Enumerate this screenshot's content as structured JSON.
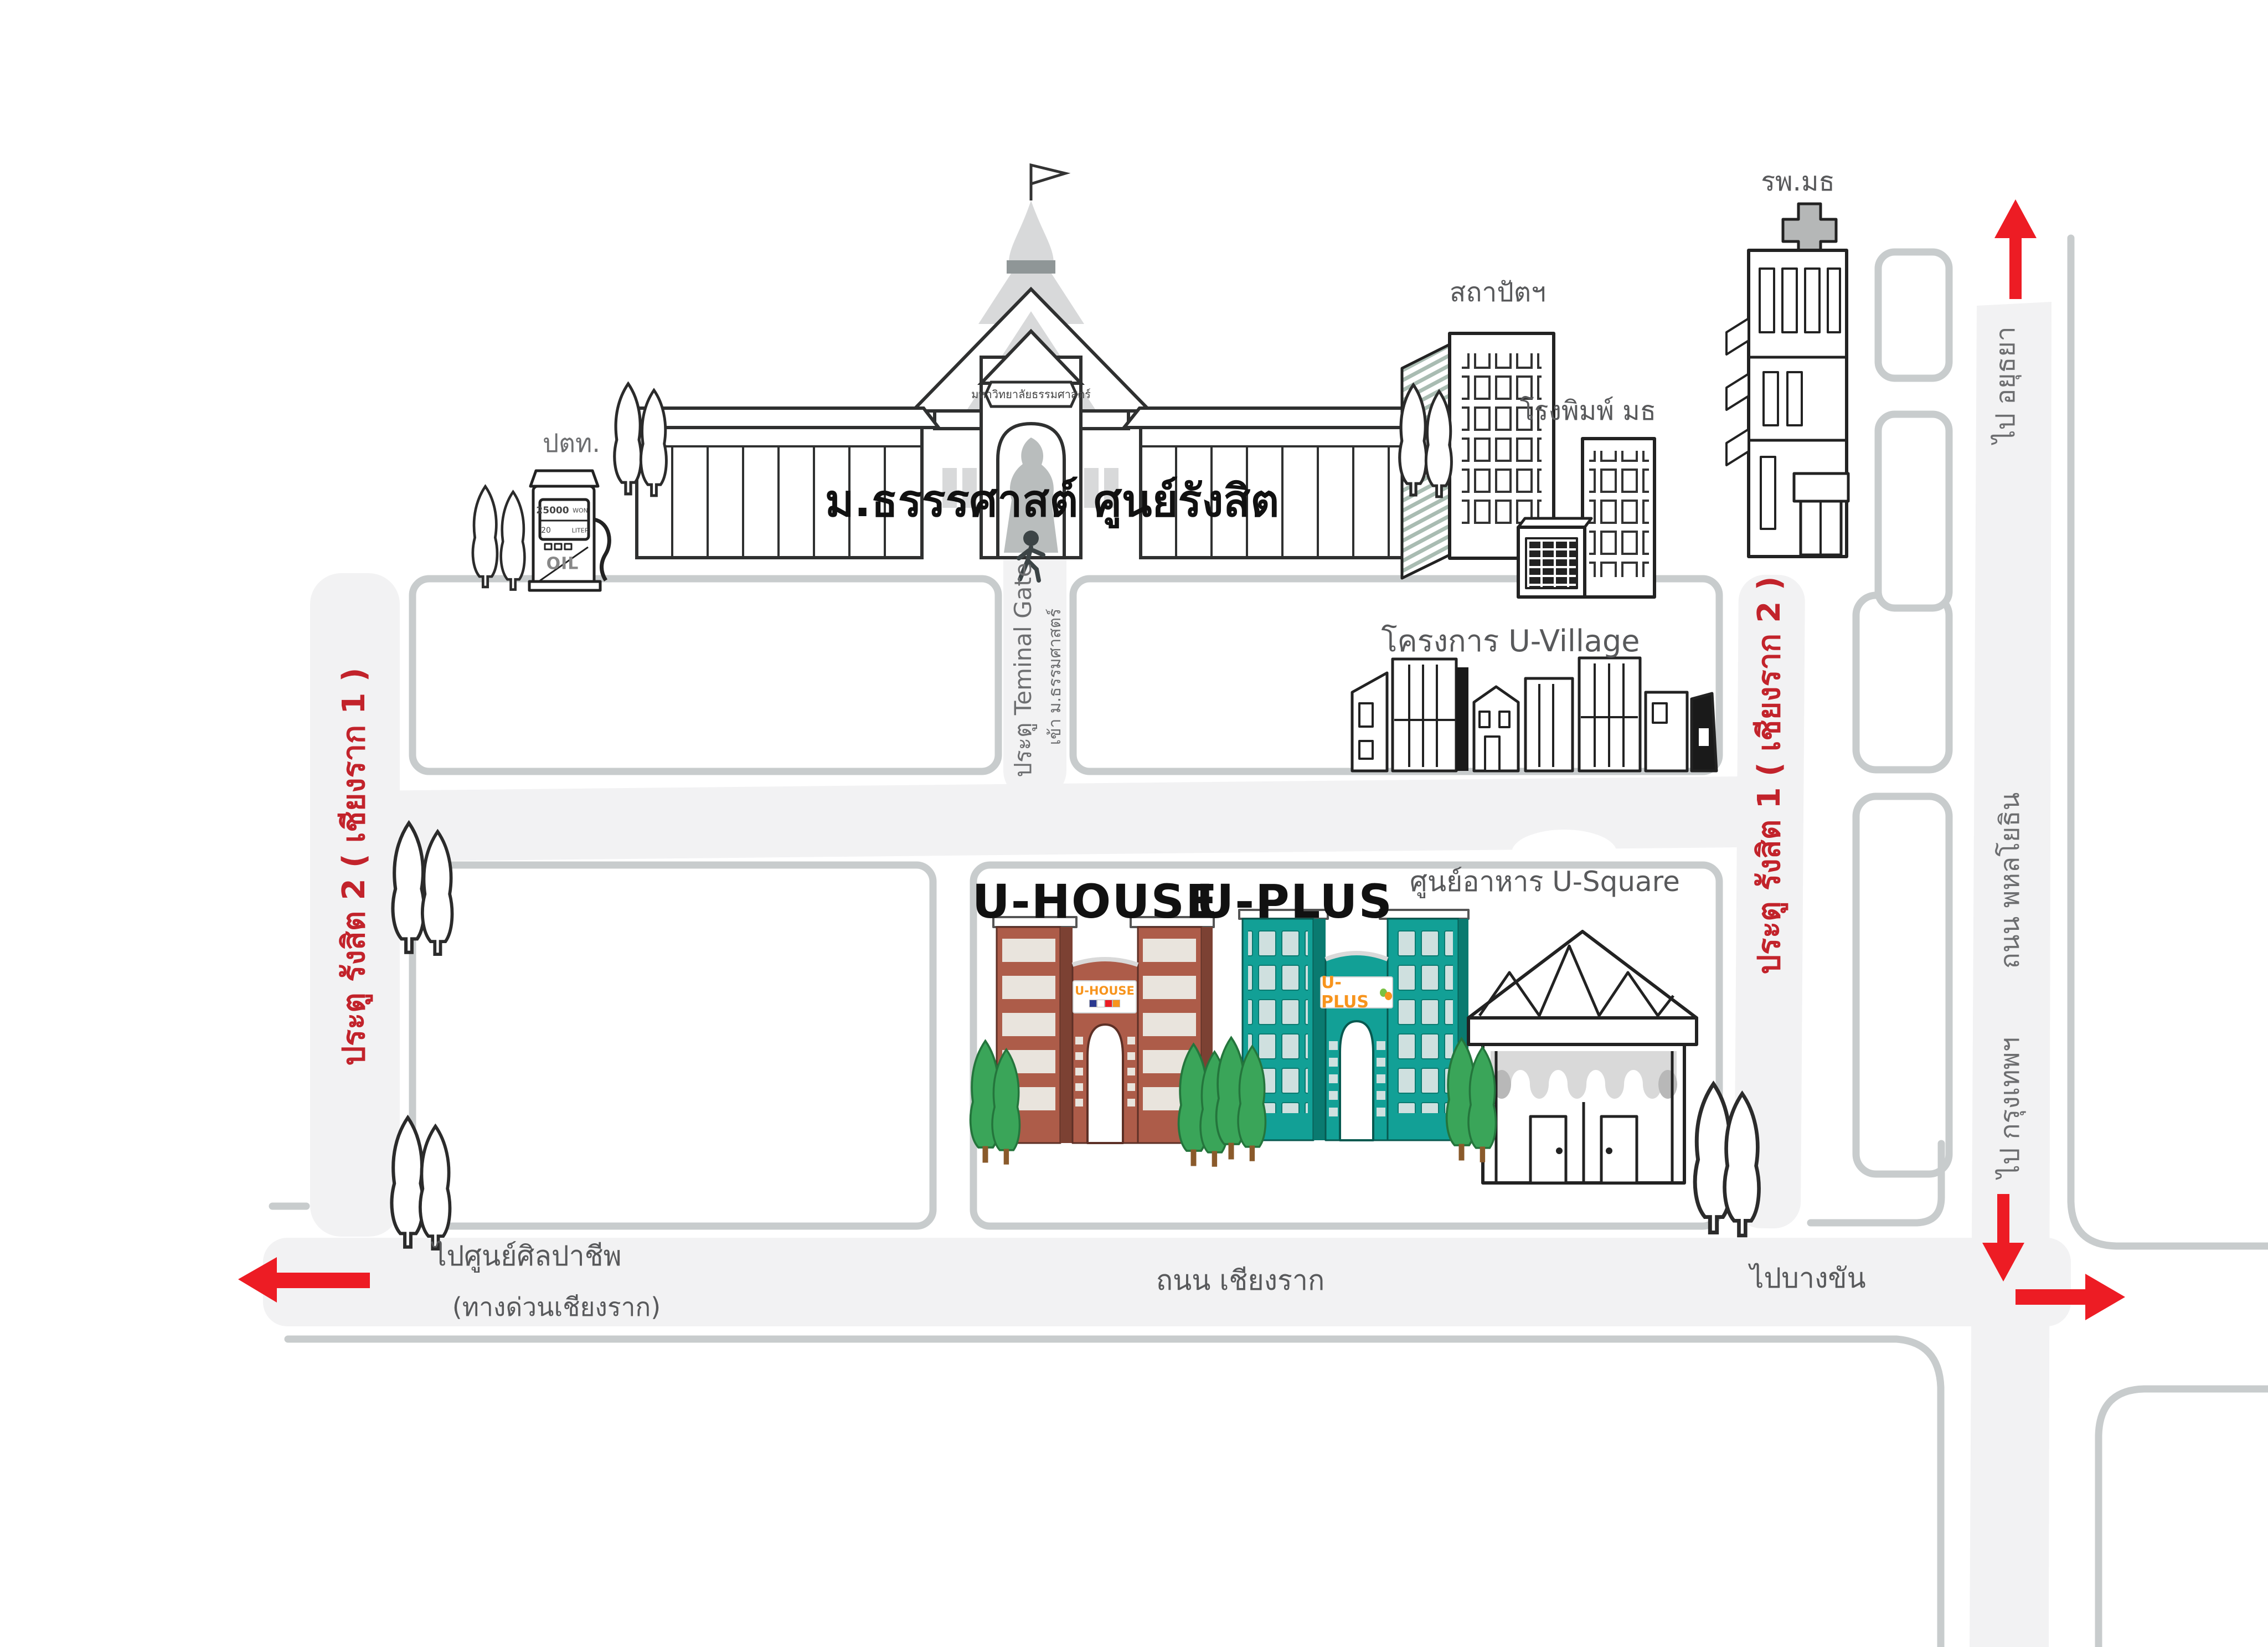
{
  "title": "ม.ธรรรศาสต์ ศูนย์รังสิต",
  "campus_sign": "มหาวิทยาลัยธรรมศาสตร์",
  "landmarks": {
    "ptt": "ปตท.",
    "architecture": "สถาปัตฯ",
    "printing_house": "โรงพิมพ์ มธ",
    "hospital": "รพ.มธ",
    "u_village": "โครงการ U-Village",
    "u_house": "U-HOUSE",
    "u_house_sign": "U-HOUSE",
    "u_plus": "U-PLUS",
    "u_plus_sign": "U-PLUS",
    "u_square": "ศูนย์อาหาร U-Square"
  },
  "gates": {
    "rangsit2": "ประตู รังสิต 2  ( เชียงราก 1 )",
    "rangsit1": "ประตู รังสิต 1 ( เชียงราก 2 )",
    "terminal": "ประตู Teminal Gate",
    "terminal_sub": "เข้า ม.ธรรมศาสตร์"
  },
  "roads": {
    "phahonyothin": "ถนน พหลโยธิน",
    "chiangrak": "ถนน เชียงราก"
  },
  "directions": {
    "to_ayutthaya": "ไป อยุธยา",
    "to_bangkok": "ไป กรุงเทพฯ",
    "to_bangkhan": "ไปบางขัน",
    "to_silpachip": "ไปศูนย์ศิลปาชีพ",
    "to_silpachip_sub": "(ทางด่วนเชียงราก)"
  },
  "pump": {
    "price": "25000",
    "unit1": "WON",
    "qty": "20",
    "unit2": "LITER",
    "brand": "OIL"
  },
  "colors": {
    "road_fill": "#f2f2f3",
    "road_edge": "#c8cccd",
    "label_gray": "#58595b",
    "gate_red": "#c2232b",
    "arrow_red": "#ed1c24",
    "uhouse_brown": "#ad5c49",
    "uhouse_dark": "#7c4133",
    "uplus_teal": "#12a096",
    "uplus_dark": "#0a7a70",
    "tree_green": "#3aa559",
    "sign_orange": "#f7941d"
  }
}
